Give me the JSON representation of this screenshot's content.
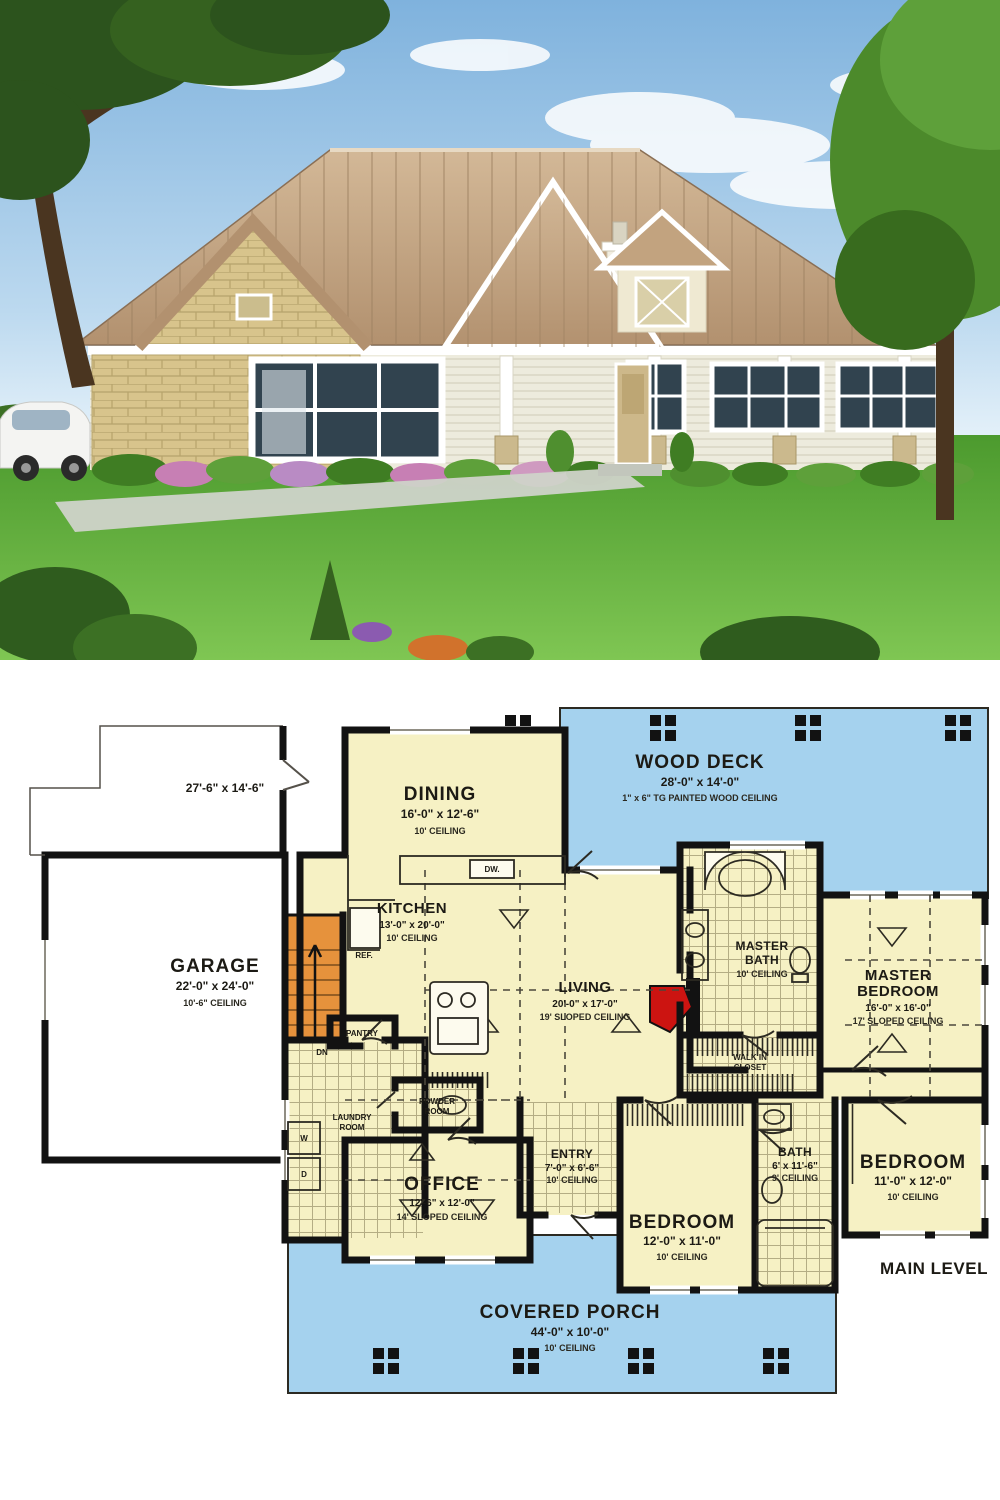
{
  "photo": {
    "subject": "single-story-country-house-exterior",
    "colors": {
      "sky_top": "#7fb2dd",
      "sky_bottom": "#dff0fa",
      "roof_tan": "#c9ab89",
      "roof_shadow": "#b2916f",
      "stone": "#d8c48c",
      "siding": "#edebdd",
      "trim_white": "#ffffff",
      "grass": "#57a335",
      "grass_light": "#7fc653",
      "tree_dark": "#2c531d",
      "tree_light": "#4c8a2b",
      "flower_pink": "#c77fb4",
      "flower_orange": "#d1722c",
      "car_white": "#f4f4f2"
    }
  },
  "plan": {
    "colors": {
      "room_fill": "#f6f1c4",
      "outdoor_blue": "#a5d2ee",
      "wall_black": "#121212",
      "stair_orange": "#e6923c",
      "fireplace_red": "#cc1411",
      "tile_line": "#a49c74"
    },
    "deck": {
      "name": "WOOD DECK",
      "dims": "28'-0\" x 14'-0\"",
      "note": "1\" x 6\" TG PAINTED WOOD CEILING"
    },
    "porch": {
      "name": "COVERED PORCH",
      "dims": "44'-0\" x 10'-0\"",
      "ceiling": "10' CEILING"
    },
    "garage_pad_dims": "27'-6\" x 14'-6\"",
    "rooms": {
      "garage": {
        "name": "GARAGE",
        "dims": "22'-0\" x 24'-0\"",
        "ceiling": "10'-6\" CEILING"
      },
      "dining": {
        "name": "DINING",
        "dims": "16'-0\" x 12'-6\"",
        "ceiling": "10' CEILING"
      },
      "kitchen": {
        "name": "KITCHEN",
        "dims": "13'-0\" x 20'-0\"",
        "ceiling": "10' CEILING"
      },
      "living": {
        "name": "LIVING",
        "dims": "20'-0\" x 17'-0\"",
        "ceiling": "19' SLOPED CEILING"
      },
      "master_bath": {
        "name": "MASTER",
        "name2": "BATH",
        "ceiling": "10' CEILING"
      },
      "master_bedroom": {
        "name": "MASTER",
        "name2": "BEDROOM",
        "dims": "16'-0\" x 16'-0\"",
        "ceiling": "17' SLOPED CEILING"
      },
      "walk_in_closet": {
        "name": "WALK IN",
        "name2": "CLOSET"
      },
      "bedroom_right": {
        "name": "BEDROOM",
        "dims": "11'-0\" x 12'-0\"",
        "ceiling": "10' CEILING"
      },
      "bath": {
        "name": "BATH",
        "dims": "6' x 11'-6\"",
        "ceiling": "9' CEILING"
      },
      "bedroom_front": {
        "name": "BEDROOM",
        "dims": "12'-0\" x 11'-0\"",
        "ceiling": "10' CEILING"
      },
      "entry": {
        "name": "ENTRY",
        "dims": "7'-0\" x 6'-6\"",
        "ceiling": "10' CEILING"
      },
      "office": {
        "name": "OFFICE",
        "dims": "12'-6\" x 12'-0\"",
        "ceiling": "14' SLOPED CEILING"
      },
      "laundry": {
        "name": "LAUNDRY",
        "name2": "ROOM"
      },
      "powder": {
        "name": "POWDER",
        "name2": "ROOM"
      },
      "pantry": {
        "name": "PANTRY"
      }
    },
    "labels": {
      "ref": "REF.",
      "dw": "DW.",
      "dn": "DN",
      "washer": "W",
      "dryer": "D",
      "main_level": "MAIN LEVEL"
    }
  }
}
